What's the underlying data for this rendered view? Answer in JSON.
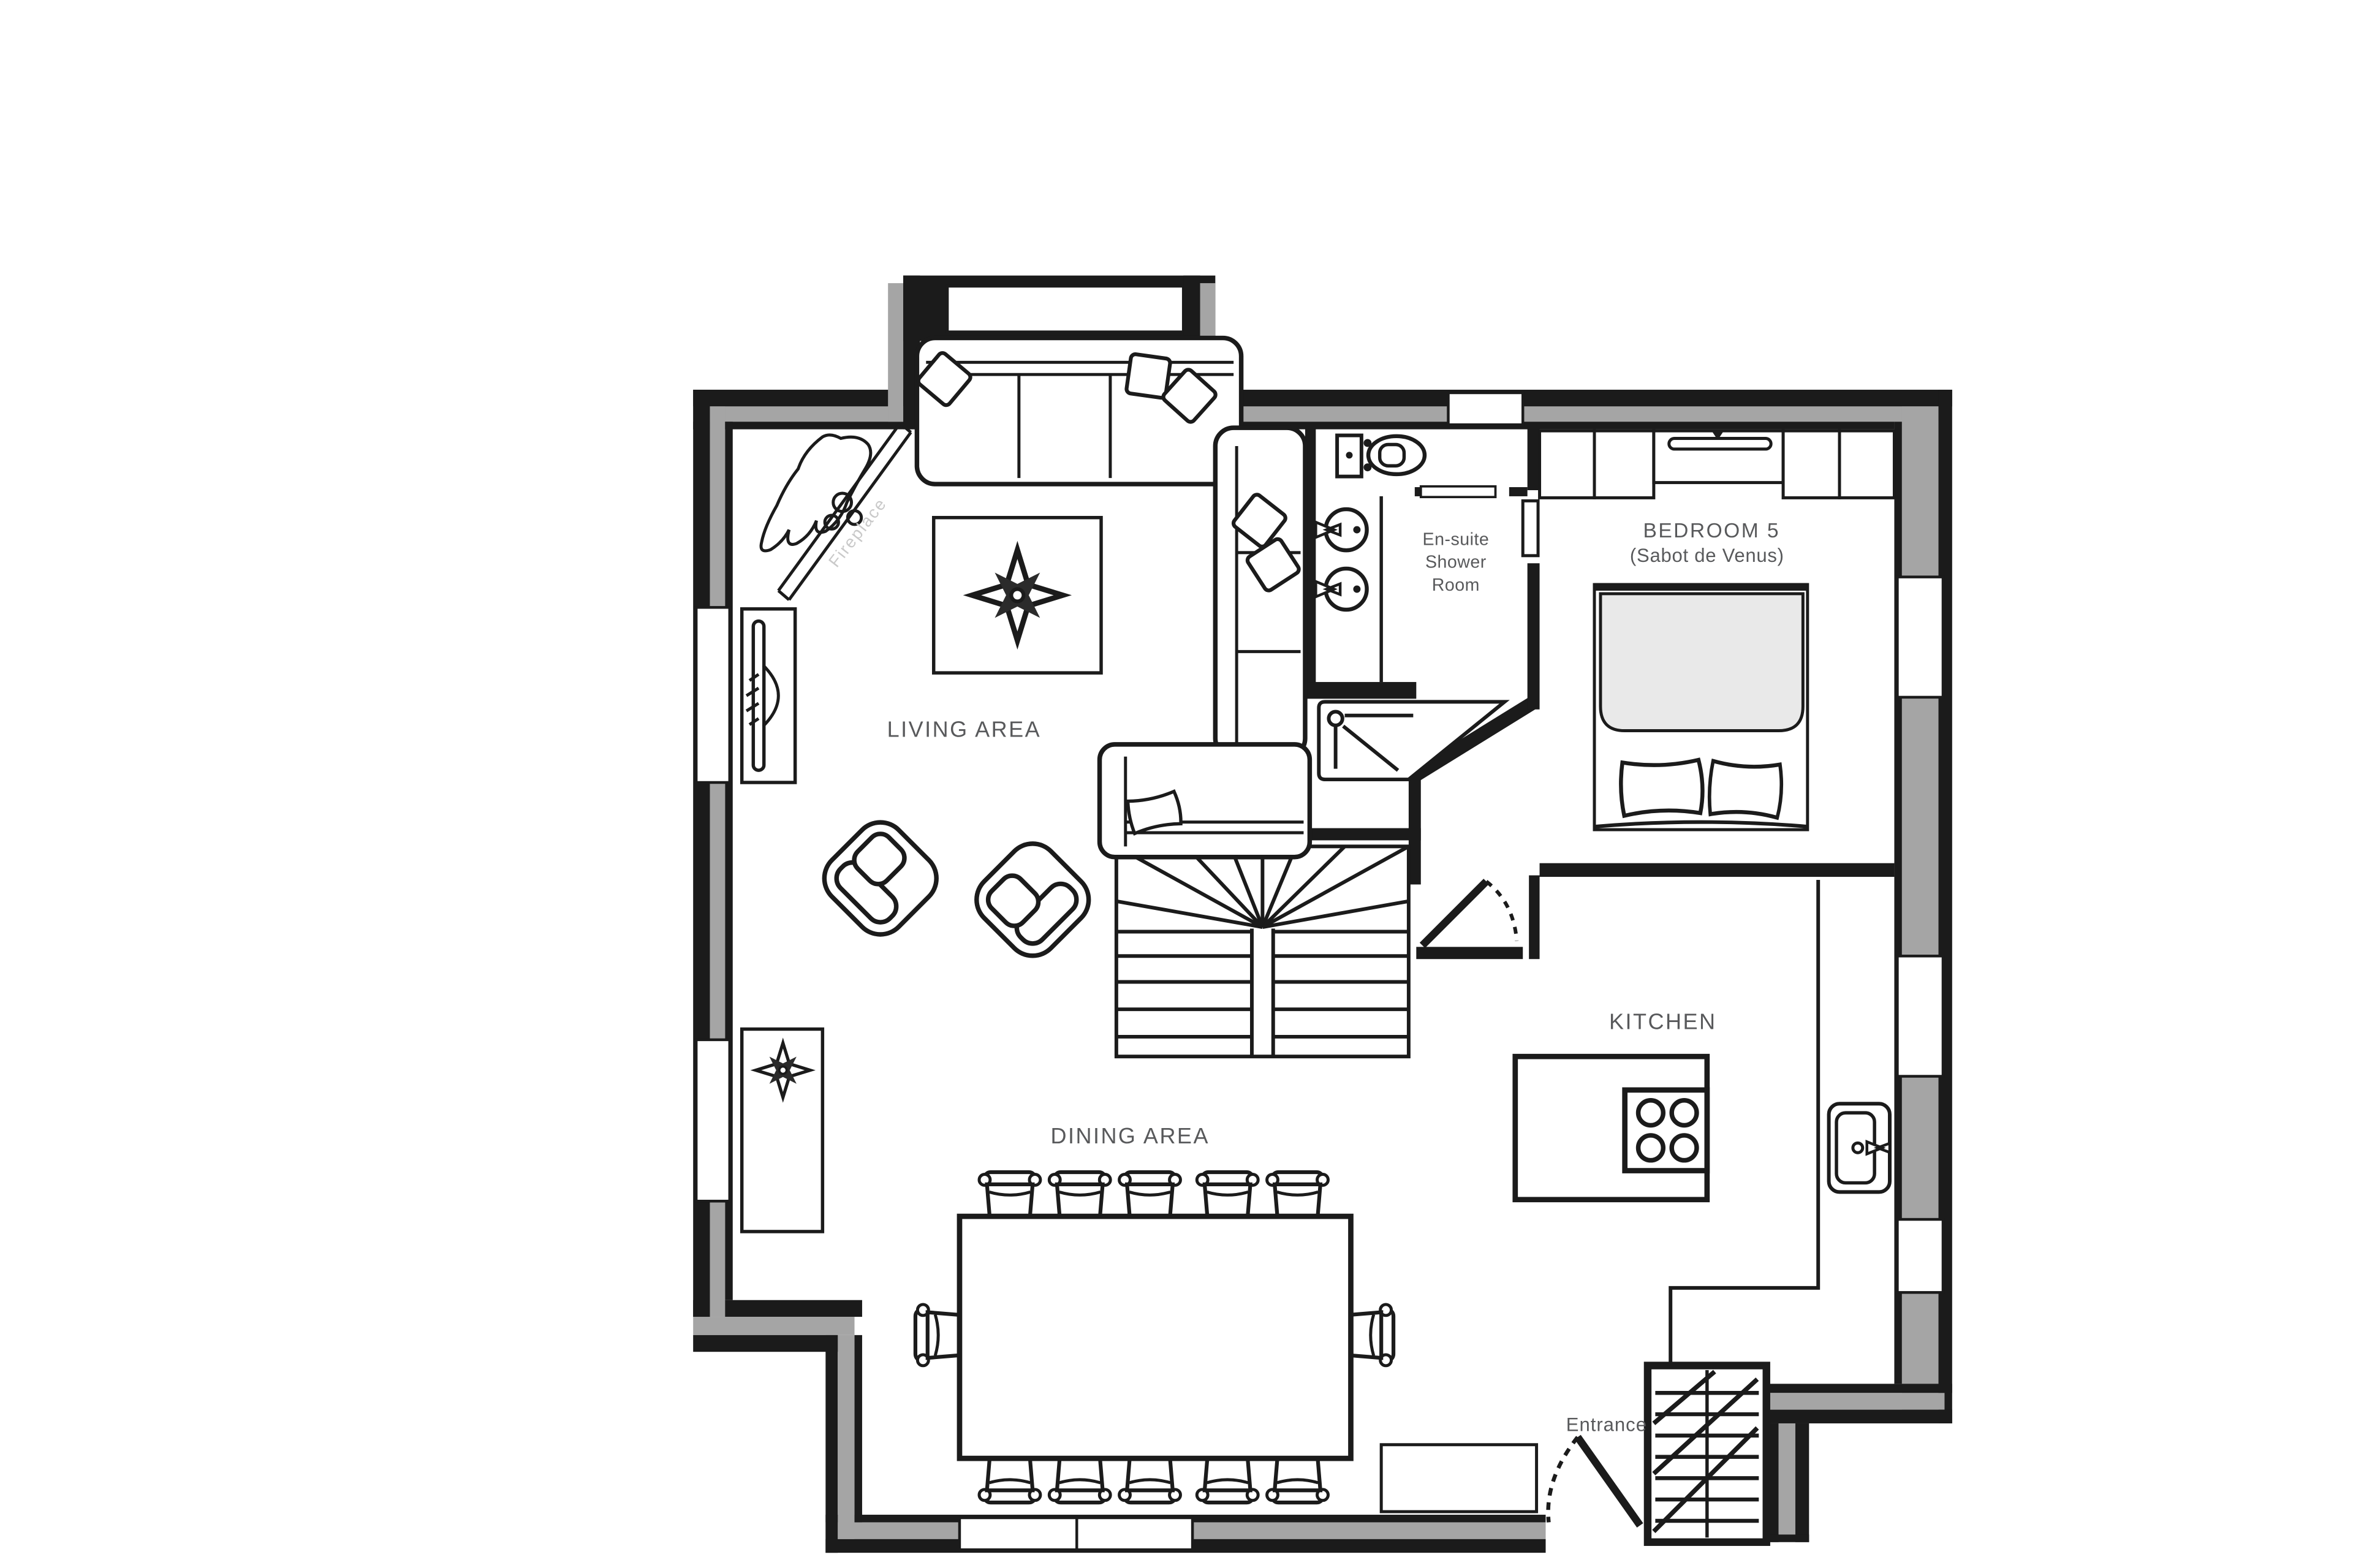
{
  "title": "Chalet ground floor plan",
  "labels": {
    "living": "LIVING AREA",
    "dining": "DINING AREA",
    "kitchen": "KITCHEN",
    "bedroom_line1": "BEDROOM 5",
    "bedroom_line2": "(Sabot de Venus)",
    "ensuite": [
      "En-suite",
      "Shower",
      "Room"
    ],
    "entrance": "Entrance",
    "fireplace": "Fireplace"
  },
  "colors": {
    "wall_black": "#1b1b1b",
    "wall_gray": "#a5a5a5",
    "label_gray": "#58595b",
    "faint_gray": "#c9c9c9",
    "duvet_gray": "#e9e9e9",
    "background": "#ffffff"
  },
  "icons": {
    "stairs": "double winder staircase",
    "hob": "4-ring hob",
    "sink": "kitchen sink",
    "toilet": "wc",
    "basins": "twin basins",
    "shower": "shower tray",
    "bed": "double bed",
    "sofa": "corner sofa",
    "armchairs": 2,
    "dining_seats": 12,
    "compass_stars": 2
  }
}
